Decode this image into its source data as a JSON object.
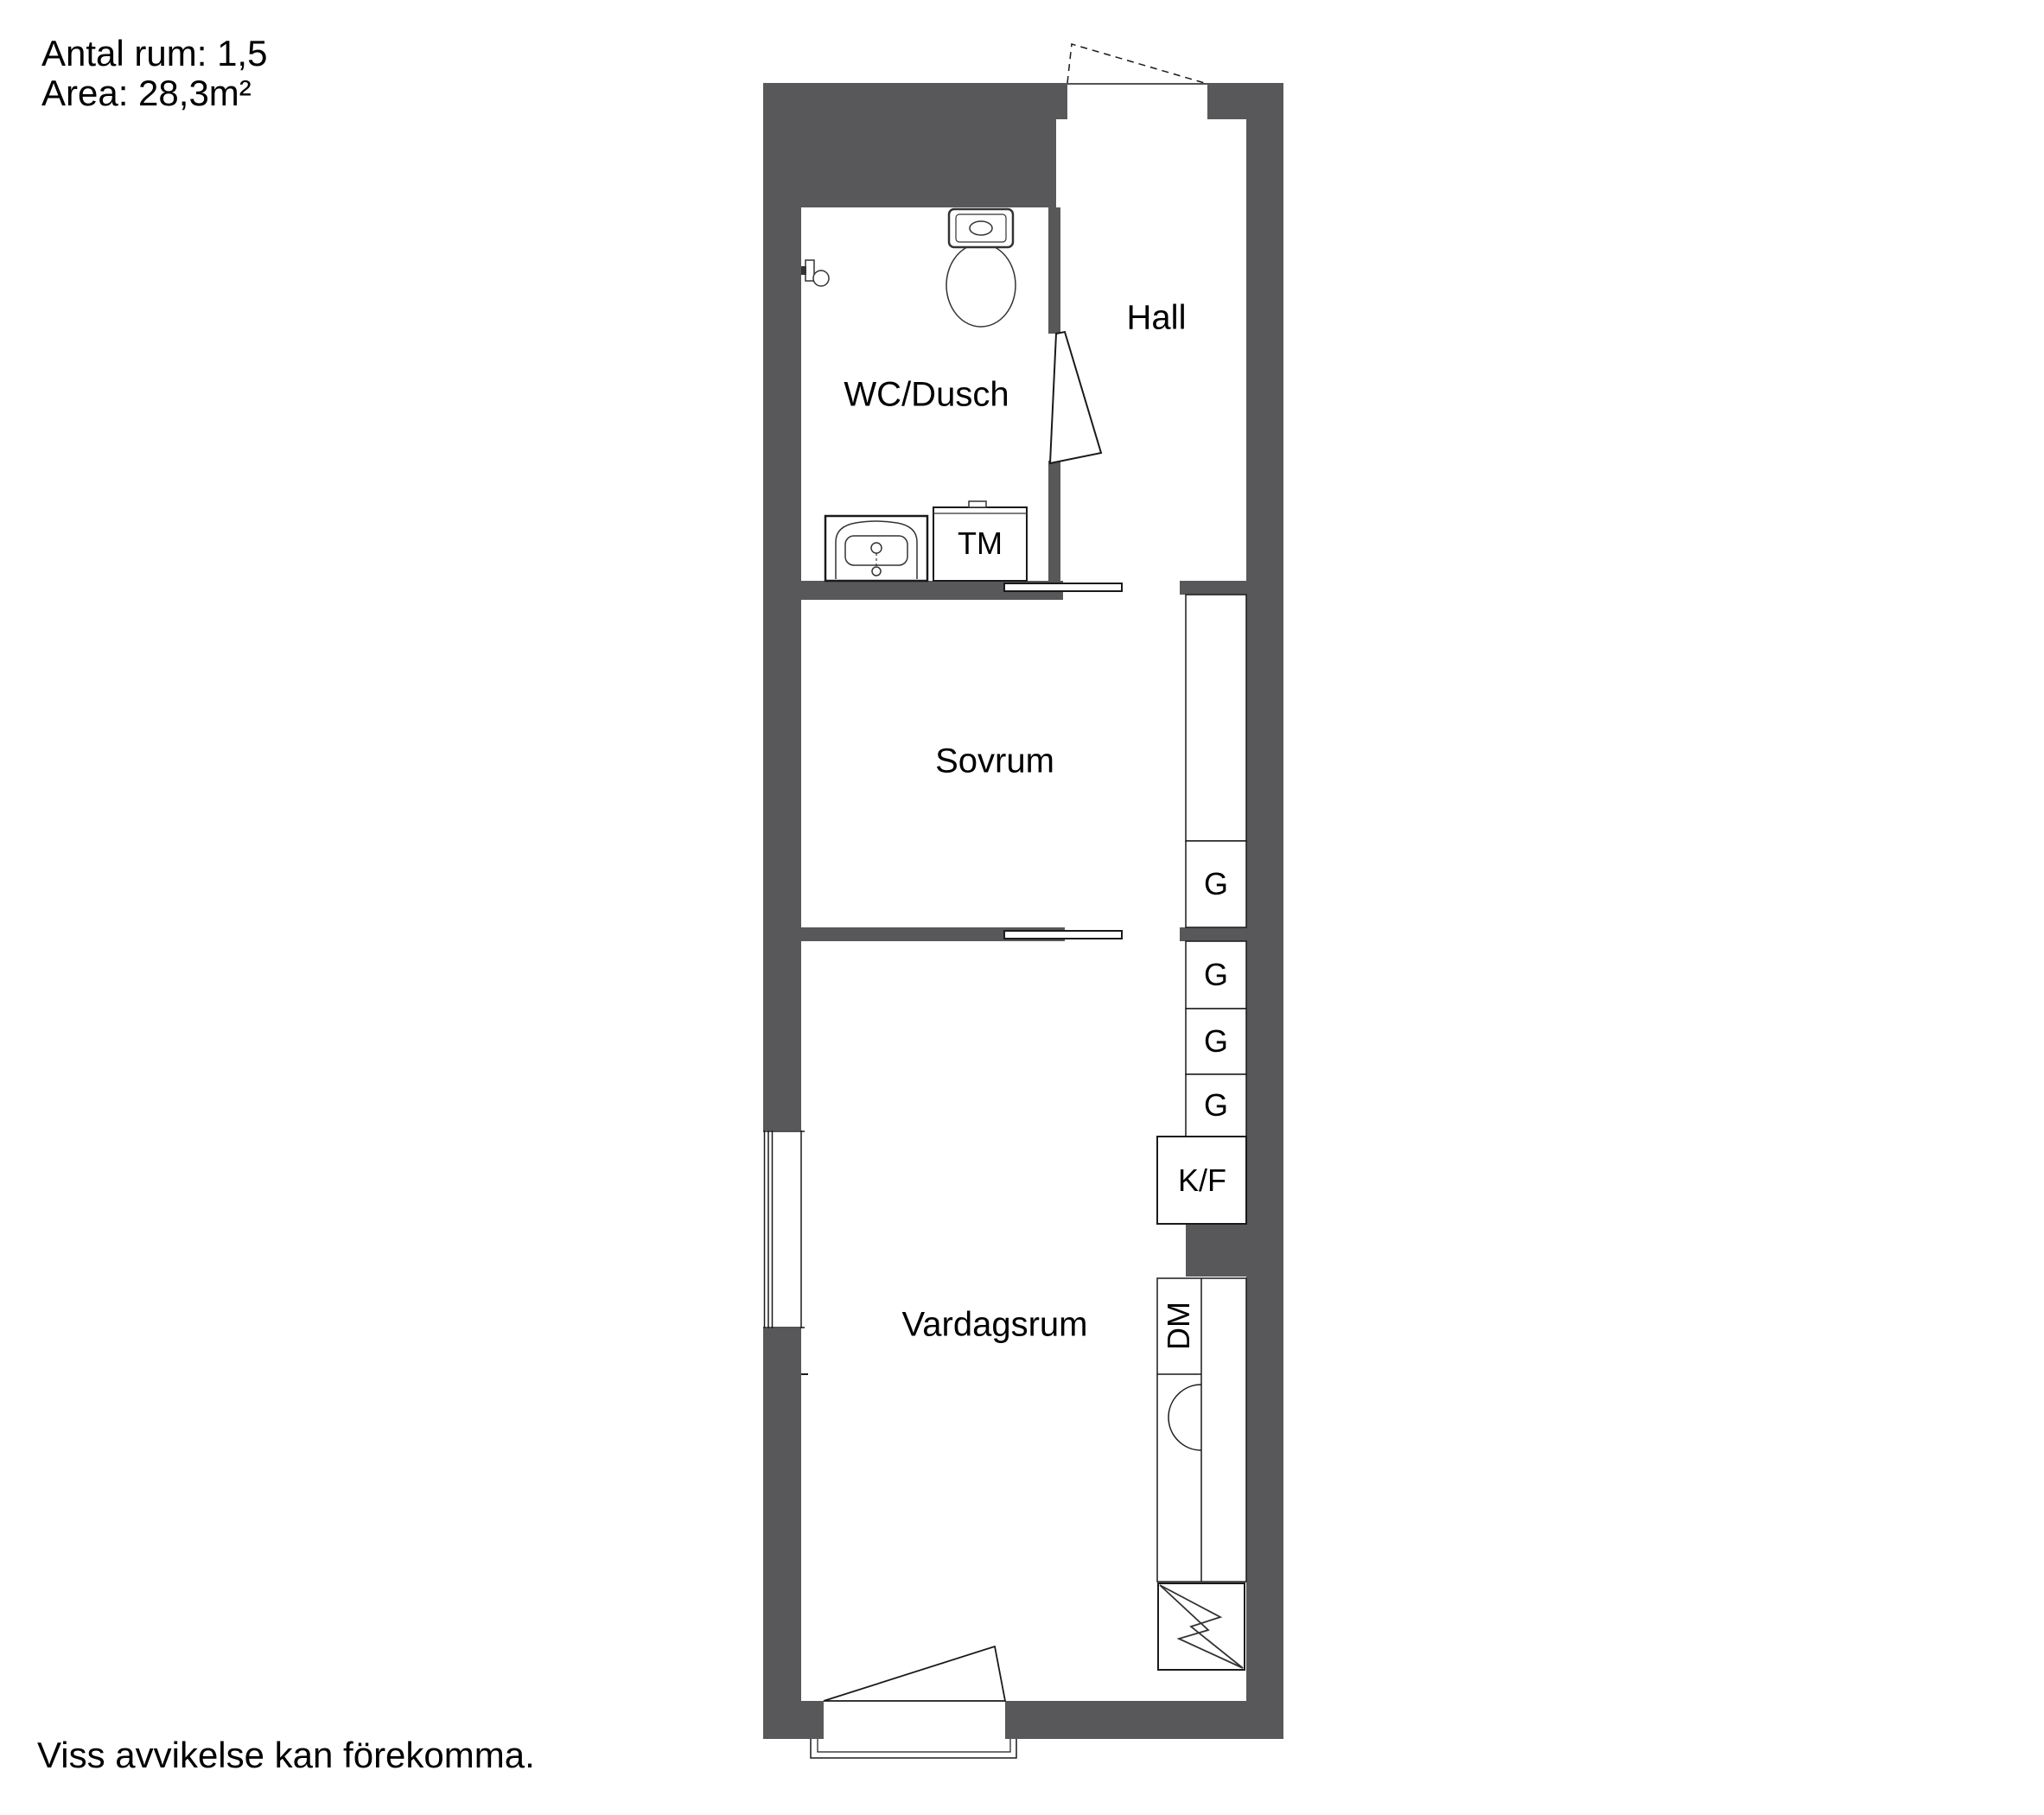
{
  "header": {
    "rooms_line": "Antal rum: 1,5",
    "area_line": "Area: 28,3m²"
  },
  "stats": {
    "antal_rum": "1,5",
    "area_m2": "28,3"
  },
  "rooms": {
    "hall": "Hall",
    "wc_dusch": "WC/Dusch",
    "sovrum": "Sovrum",
    "vardagsrum": "Vardagsrum"
  },
  "appliances": {
    "tm": "TM",
    "kf": "K/F",
    "dm": "DM"
  },
  "wardrobes": [
    "G",
    "G",
    "G",
    "G"
  ],
  "footer": {
    "disclaimer": "Viss avvikelse kan förekomma."
  },
  "colors": {
    "wall": "#58585a",
    "line": "#1a1a1a",
    "text": "#000000",
    "background": "#ffffff"
  }
}
